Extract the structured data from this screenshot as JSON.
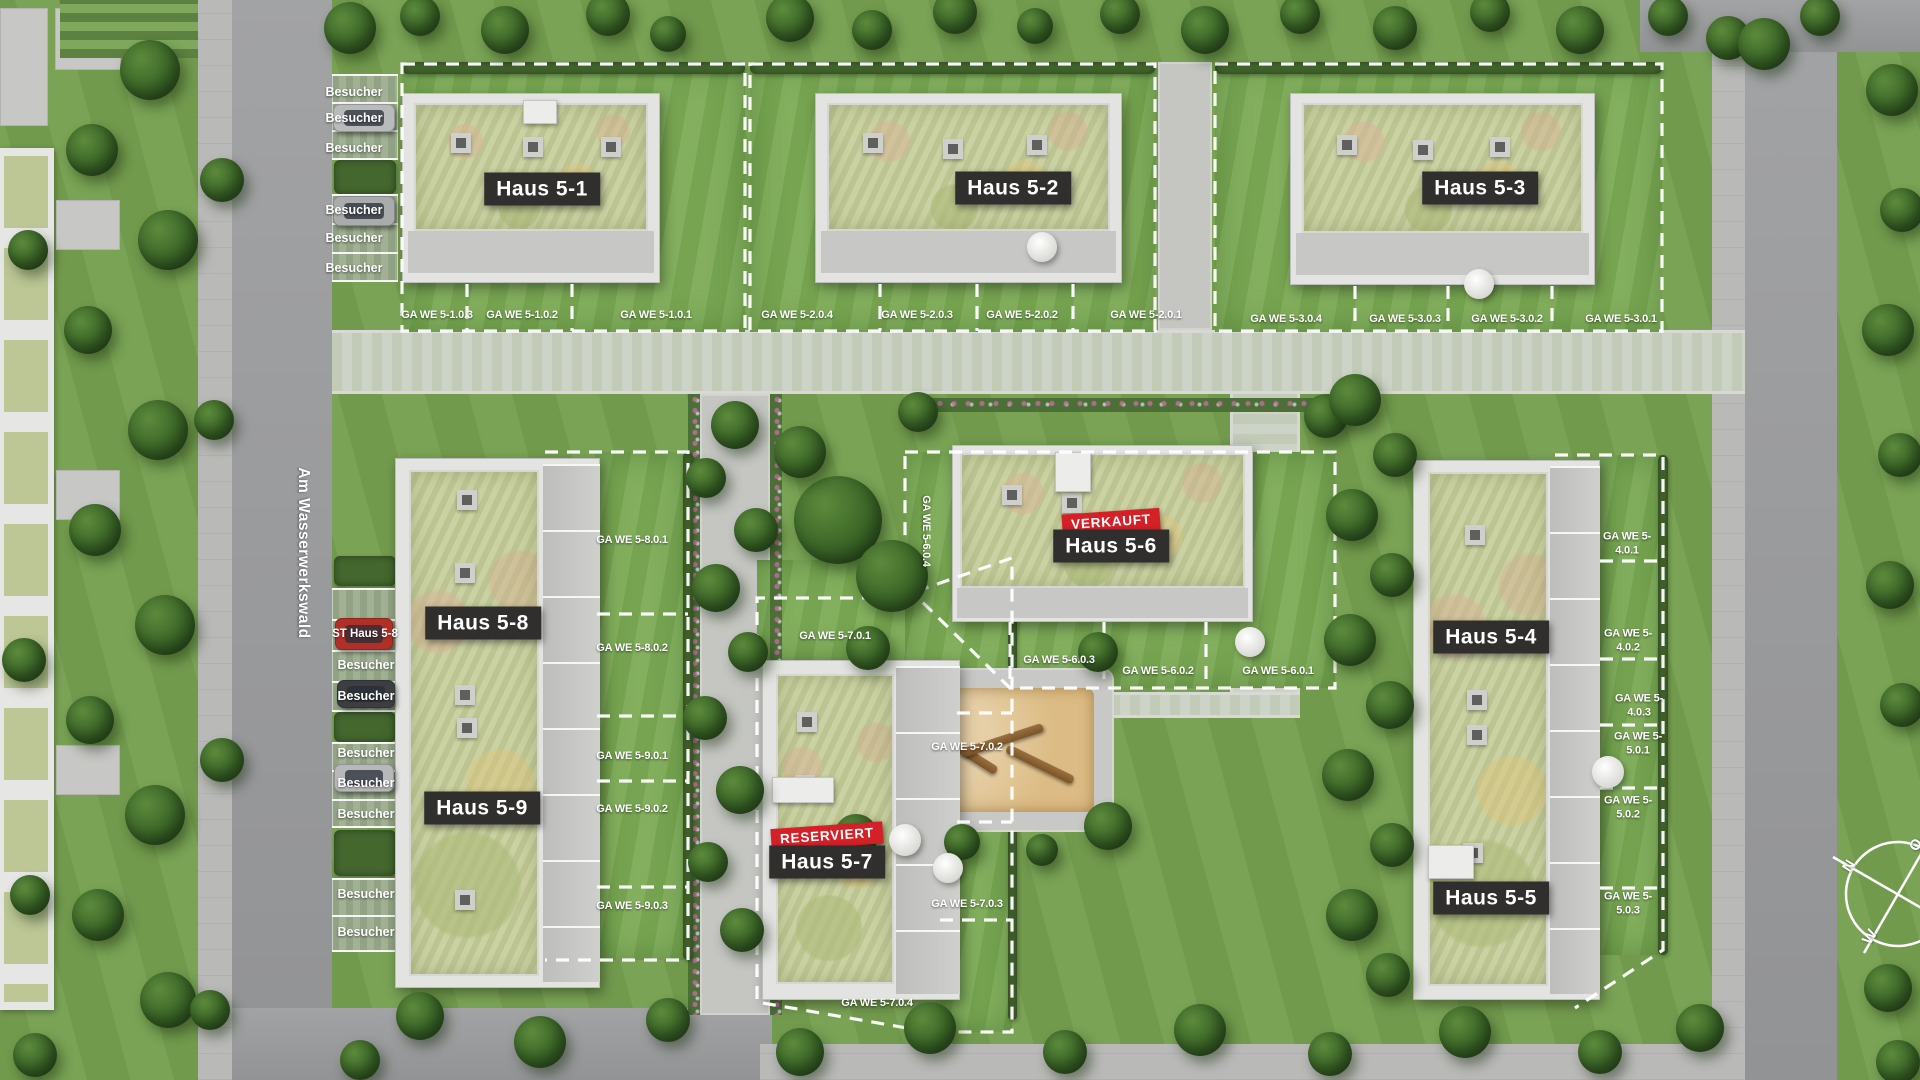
{
  "street": {
    "name": "Am Wasserwerkswald"
  },
  "parking": {
    "visitor_label": "Besucher",
    "st_label": "ST Haus 5-8"
  },
  "buildings": [
    {
      "name": "haus-5-1",
      "label": "Haus 5-1"
    },
    {
      "name": "haus-5-2",
      "label": "Haus 5-2"
    },
    {
      "name": "haus-5-3",
      "label": "Haus 5-3"
    },
    {
      "name": "haus-5-4",
      "label": "Haus 5-4"
    },
    {
      "name": "haus-5-5",
      "label": "Haus 5-5"
    },
    {
      "name": "haus-5-6",
      "label": "Haus 5-6",
      "status": "VERKAUFT"
    },
    {
      "name": "haus-5-7",
      "label": "Haus 5-7",
      "status": "RESERVIERT"
    },
    {
      "name": "haus-5-8",
      "label": "Haus 5-8"
    },
    {
      "name": "haus-5-9",
      "label": "Haus 5-9"
    }
  ],
  "garden_units": [
    {
      "code": "GA WE 5-1.0.3"
    },
    {
      "code": "GA WE 5-1.0.2"
    },
    {
      "code": "GA WE 5-1.0.1"
    },
    {
      "code": "GA WE 5-2.0.4"
    },
    {
      "code": "GA WE 5-2.0.3"
    },
    {
      "code": "GA WE 5-2.0.2"
    },
    {
      "code": "GA WE 5-2.0.1"
    },
    {
      "code": "GA WE 5-3.0.4"
    },
    {
      "code": "GA WE 5-3.0.3"
    },
    {
      "code": "GA WE 5-3.0.2"
    },
    {
      "code": "GA WE 5-3.0.1"
    },
    {
      "code": "GA WE 5-8.0.1"
    },
    {
      "code": "GA WE 5-8.0.2"
    },
    {
      "code": "GA WE 5-9.0.1"
    },
    {
      "code": "GA WE 5-9.0.2"
    },
    {
      "code": "GA WE 5-9.0.3"
    },
    {
      "code": "GA WE 5-7.0.1"
    },
    {
      "code": "GA WE 5-7.0.2"
    },
    {
      "code": "GA WE 5-7.0.3"
    },
    {
      "code": "GA WE 5-7.0.4"
    },
    {
      "code": "GA WE 5-6.0.4"
    },
    {
      "code": "GA WE 5-6.0.3"
    },
    {
      "code": "GA WE 5-6.0.2"
    },
    {
      "code": "GA WE 5-6.0.1"
    },
    {
      "code": "GA WE 5-4.0.1"
    },
    {
      "code": "GA WE 5-4.0.2"
    },
    {
      "code": "GA WE 5-4.0.3"
    },
    {
      "code": "GA WE 5-5.0.1"
    },
    {
      "code": "GA WE 5-5.0.2"
    },
    {
      "code": "GA WE 5-5.0.3"
    }
  ],
  "compass": {
    "north": "N",
    "west": "W",
    "east": "O"
  },
  "colors": {
    "status_badge_bg": "#d42127",
    "building_label_bg": "#312f2d",
    "label_text": "#ffffff",
    "boundary_dashed": "#ffffff"
  }
}
